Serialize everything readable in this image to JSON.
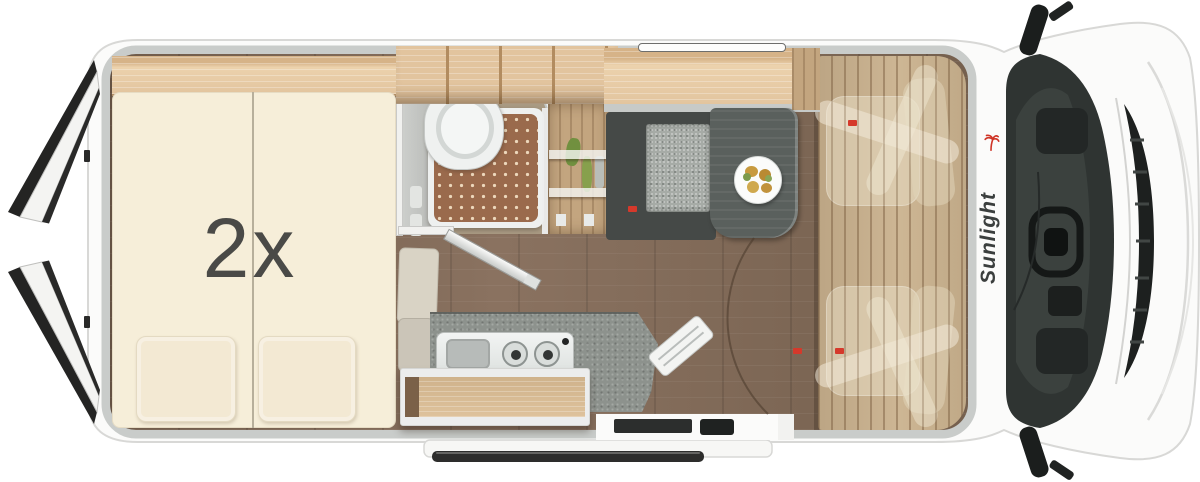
{
  "meta": {
    "view": "motorhome-top-view-floorplan",
    "canvas_width": 1200,
    "canvas_height": 482
  },
  "brand": {
    "name": "Sunlight",
    "logo_icon": "palm-tree-icon",
    "text_color": "#3b3f3e",
    "accent_color": "#cf3426"
  },
  "bed": {
    "label": "2x",
    "label_color": "#4a4a47"
  },
  "colors": {
    "body_white": "#fbfbfa",
    "outline_gray": "#d8d8d6",
    "rim_gray": "#c9ccca",
    "mattress_cream": "#f6eed9",
    "wood_light": "#e2c49e",
    "wood_mid": "#c3a57f",
    "cab_wood": "#c8b08e",
    "floor_dark": "#7d6857",
    "shower_mat_brown": "#9a6a4c",
    "counter_gray": "#8d928d",
    "table_gray": "#5a605d",
    "bench_cushion_gray": "#a6aba6",
    "bench_frame_dark": "#454947",
    "ceramic_white": "#f2f4f3",
    "windshield_dark": "#2f3432",
    "accent_red": "#d5392b"
  }
}
